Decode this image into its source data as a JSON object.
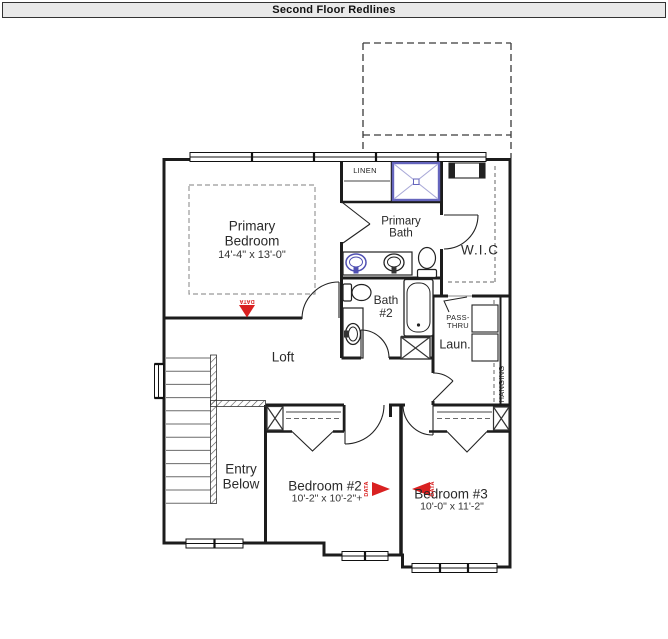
{
  "header": {
    "title": "Second Floor Redlines"
  },
  "rooms": {
    "primary_bedroom": {
      "label": "Primary\nBedroom",
      "dims": "14'-4\" x 13'-0\""
    },
    "primary_bath": {
      "label": "Primary\nBath"
    },
    "wic": {
      "label": "W.I.C"
    },
    "linen": {
      "label": "LINEN"
    },
    "bath2": {
      "label": "Bath\n#2"
    },
    "loft": {
      "label": "Loft"
    },
    "laundry": {
      "label": "Laun."
    },
    "pass_thru": {
      "label": "PASS-\nTHRU"
    },
    "hanging": {
      "label": "HANGING"
    },
    "entry_below": {
      "label": "Entry\nBelow"
    },
    "bedroom2": {
      "label": "Bedroom #2",
      "dims": "10'-2\" x 10'-2\"+"
    },
    "bedroom3": {
      "label": "Bedroom #3",
      "dims": "10'-0\" x 11'-2\""
    }
  },
  "markers": {
    "data_label": "DATA",
    "color": "#d92121"
  },
  "colors": {
    "wall": "#1c1c1c",
    "fixture_blue": "#4f4fb2",
    "shower_blue": "#6565bd",
    "header_bg": "#e9e9e9"
  }
}
